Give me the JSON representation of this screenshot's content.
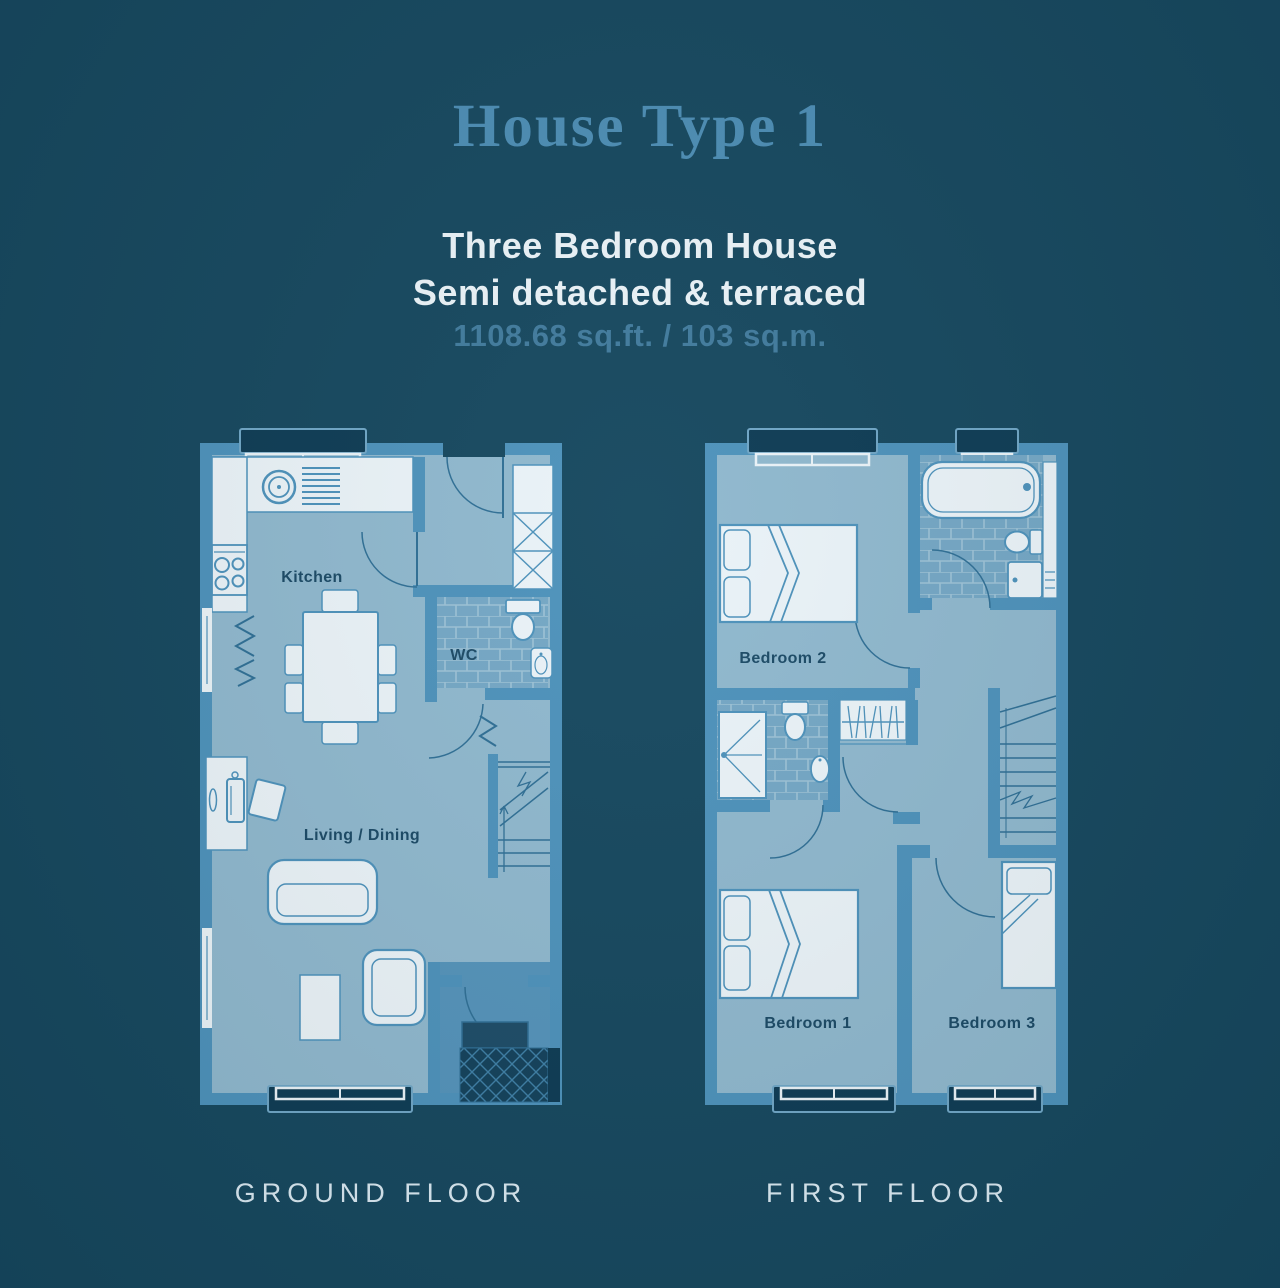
{
  "header": {
    "title": "House Type 1",
    "subtitle_line1": "Three Bedroom House",
    "subtitle_line2": "Semi detached & terraced",
    "area": "1108.68 sq.ft. / 103 sq.m."
  },
  "colors": {
    "background": "#16485F",
    "wall_blue": "#4D92BB",
    "floor_blue": "#8FB8CE",
    "fixture_white": "#EAF3F8",
    "room_label_navy": "#1B4A66",
    "title_blue": "#4C8DB4",
    "area_text_blue": "#417B9D",
    "caption_text": "#D9E9F2"
  },
  "ground_floor": {
    "caption": "GROUND FLOOR",
    "rooms": {
      "kitchen": "Kitchen",
      "wc": "WC",
      "living_dining": "Living / Dining"
    }
  },
  "first_floor": {
    "caption": "FIRST FLOOR",
    "rooms": {
      "bedroom2": "Bedroom 2",
      "bedroom1": "Bedroom 1",
      "bedroom3": "Bedroom 3"
    }
  }
}
